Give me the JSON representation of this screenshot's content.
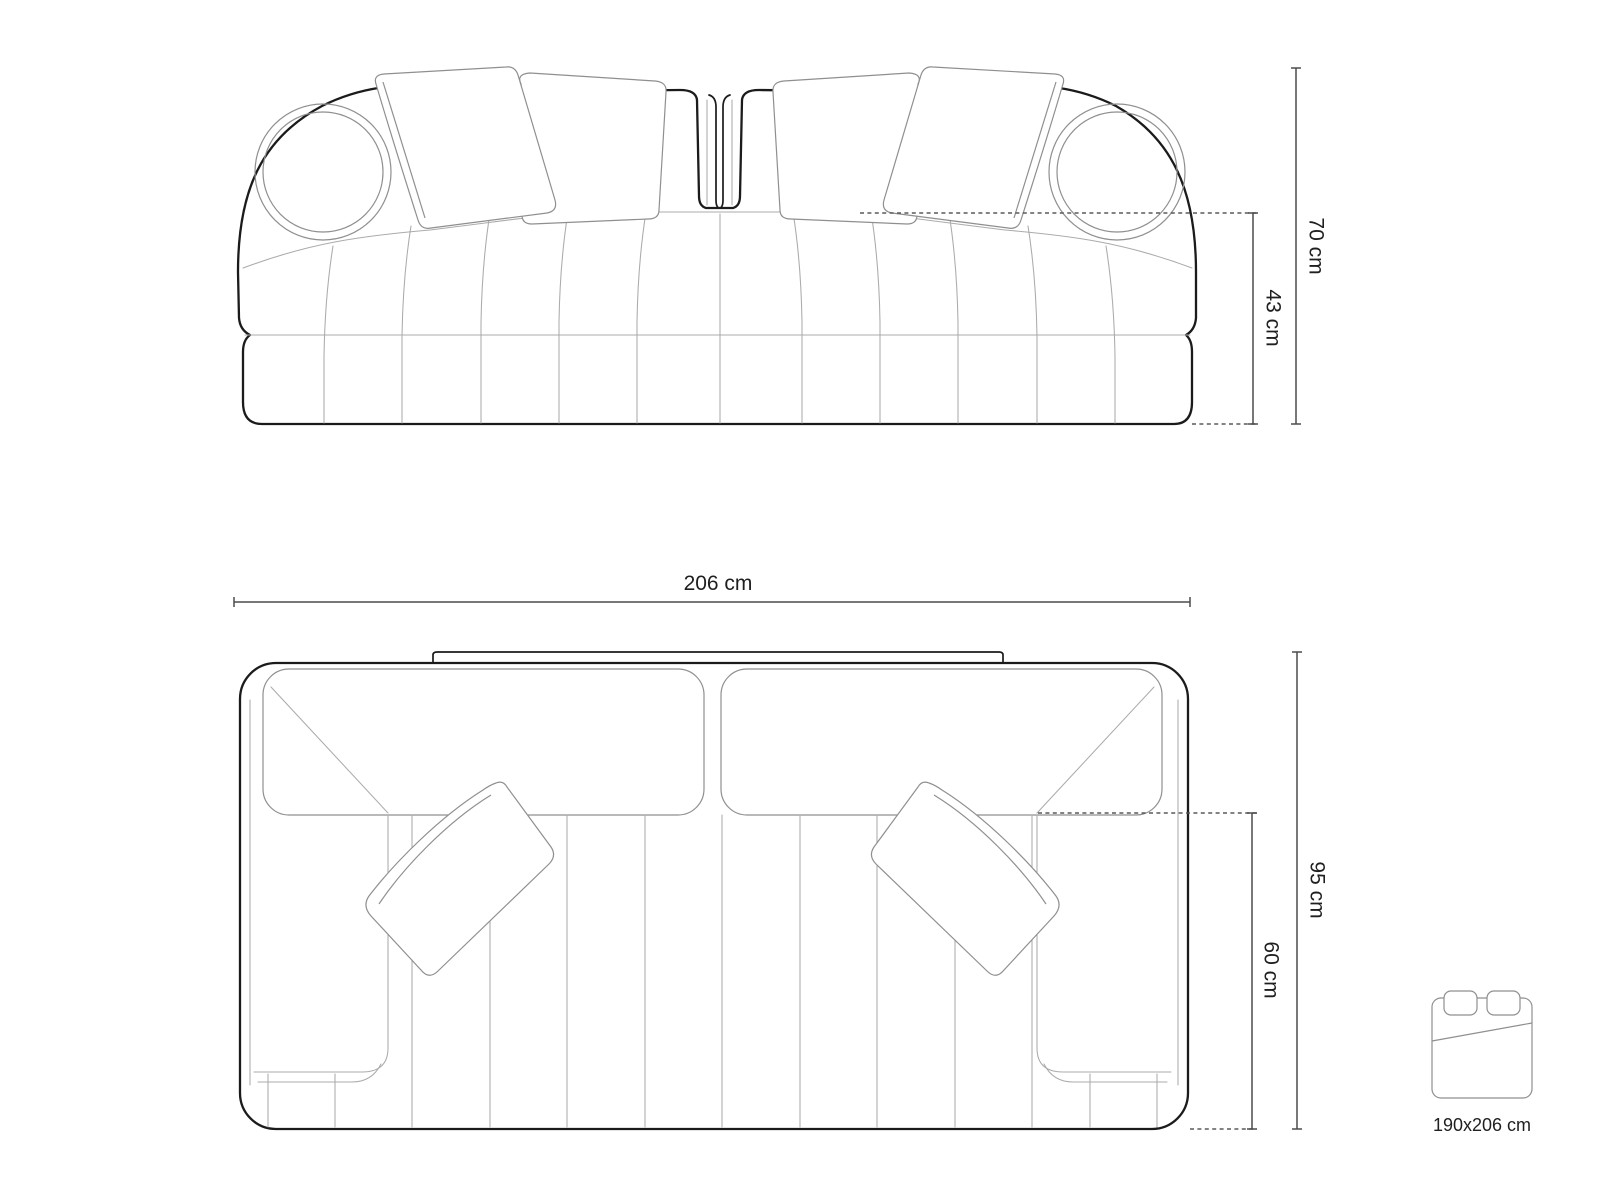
{
  "drawing": {
    "subject": "two-seat channel-tufted sofa with bolster and back cushions",
    "views": {
      "front": "front-elevation",
      "top": "top-plan"
    }
  },
  "dimensions": {
    "total_height": "70 cm",
    "seat_height": "43 cm",
    "total_width": "206 cm",
    "total_depth": "95 cm",
    "seat_depth": "60 cm"
  },
  "sleeping_function": {
    "icon": "bed-icon",
    "label": "190x206 cm"
  },
  "colors": {
    "background": "#ffffff",
    "outline": "#1b1b1b",
    "secondary_line": "#8f8f8f",
    "light_line": "#ababab",
    "dimension_line": "#4c4c4c",
    "text": "#1f1f1f"
  }
}
